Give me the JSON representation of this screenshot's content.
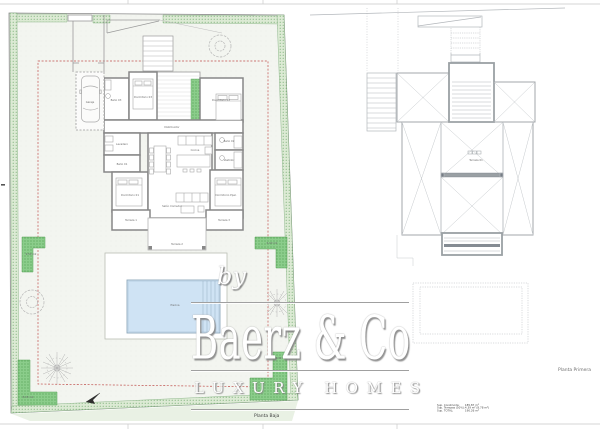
{
  "sheet": {
    "left_plan_title": "Planta Baja",
    "right_plan_title": "Planta Primera"
  },
  "watermark": {
    "prefix": "by",
    "brand": "Baerz & Co",
    "tagline": "LUXURY HOMES"
  },
  "summary": {
    "rows": [
      {
        "label": "Sup. Construida:",
        "value": "185.87 m²"
      },
      {
        "label": "Sup. Terrazas (50%):",
        "value": "4.39 m² (8.78 m²)"
      },
      {
        "label": "Sup. TOTAL:",
        "value": "190.26 m²"
      }
    ]
  },
  "plans": {
    "baja": {
      "rooms": [
        "Garaje",
        "Baño 03",
        "Dormitorio 03",
        "Dormitorio 02",
        "Lavadero",
        "Baño 01",
        "Dormitorio 01",
        "Cocina",
        "Salón Comedor",
        "Baño 02",
        "Vestidor",
        "Dormitorio Ppal.",
        "Terraza 1",
        "Terraza 3",
        "Terraza 2",
        "Piscina",
        "Distribuidor"
      ],
      "garden_areas": [
        "9.50 m2",
        "6.00 m2",
        "8.00 m2",
        "8.05 m2"
      ]
    },
    "primera": {
      "rooms": [
        "Terraza 01"
      ]
    }
  },
  "colors": {
    "lawn_green": "#8bcd8b",
    "hedge_green": "#dcead4",
    "pool_blue": "#cfe3f4",
    "setback_red": "#c0504d",
    "wall_gray": "#878787"
  }
}
